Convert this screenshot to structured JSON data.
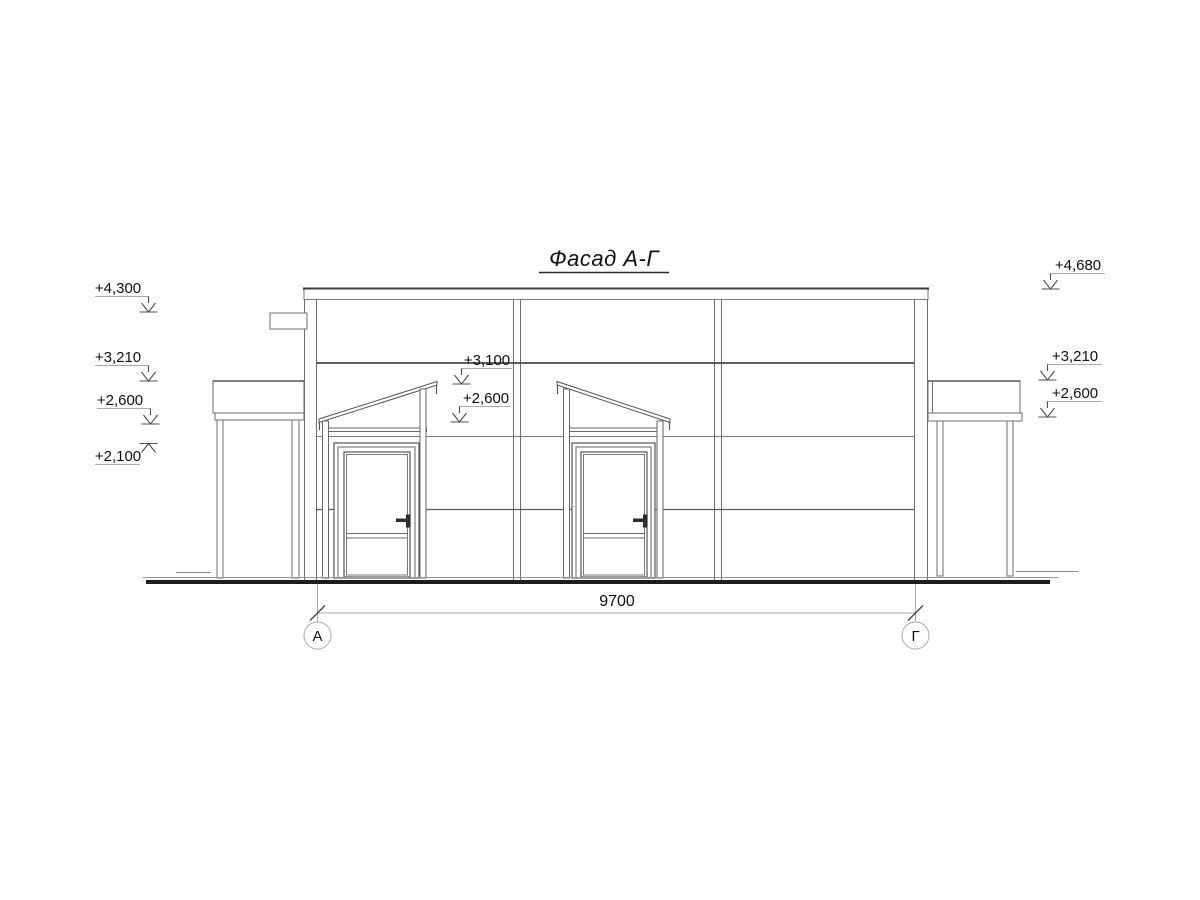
{
  "title": "Фасад А-Г",
  "levels_left": [
    "+4,300",
    "+3,210",
    "+2,600",
    "+2,100"
  ],
  "levels_middle": [
    "+3,100",
    "+2,600"
  ],
  "levels_right": [
    "+4,680",
    "+3,210",
    "+2,600"
  ],
  "dimension_total": "9700",
  "axis_left": "А",
  "axis_right": "Г",
  "colors": {
    "background": "#ffffff",
    "building_line": "#6e6e6e",
    "dark_line": "#3f3f3f",
    "ground_line": "#1d1d1d",
    "annotation_line": "#ababab",
    "text": "#111111"
  }
}
